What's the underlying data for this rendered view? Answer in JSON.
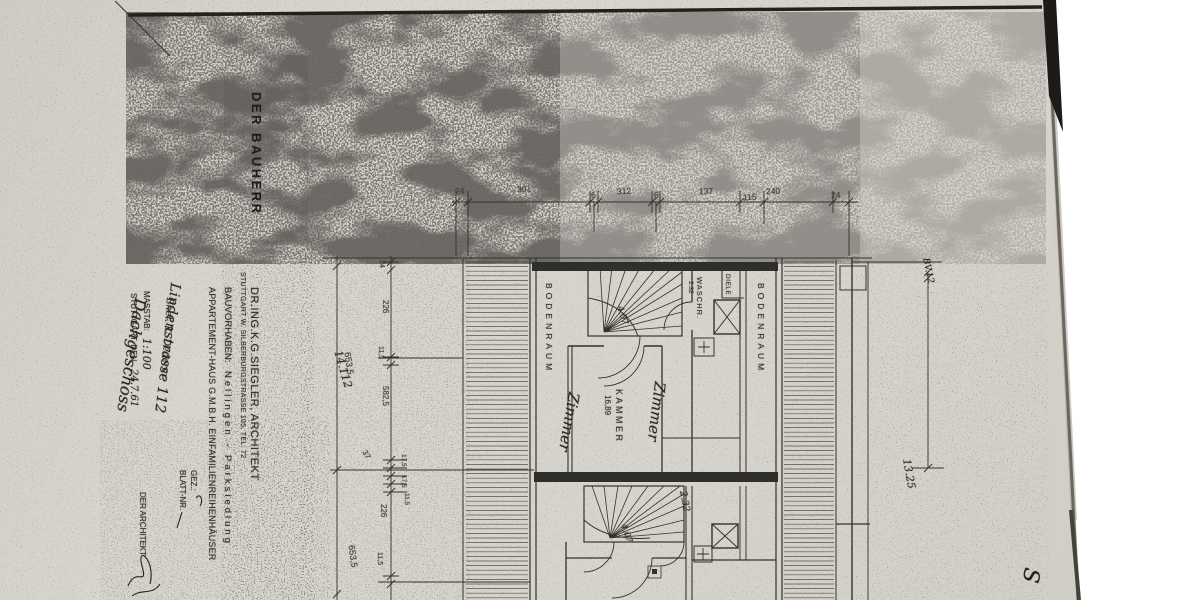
{
  "stamp": {
    "bauherr": "DER BAUHERR"
  },
  "title_block": {
    "architect": "DR.ING.K.G.SIEGLER, ARCHITEKT",
    "address": "STUTTGART W. SILBERBURGSTRASSE 105, TEL. 72",
    "project_label": "BAUVORHABEN:",
    "project": "Nellingen - Parksiedlung",
    "client": "APPARTEMENT-HAUS G.M.B.H. EINFAMILIENREIHENHÄUSER",
    "street": "Lindenstrasse 112",
    "owners": "Ehel. K. Dederer",
    "floor": "Dachgeschoss"
  },
  "meta": {
    "scale_label": "MASSTAB:",
    "scale_value": "1:100",
    "date_label": "STUTTGART, DEN",
    "date_value": "24.7.61",
    "gez_label": "GEZ.:",
    "blatt_label": "BLATT-NR.",
    "architect_label": "DER ARCHITEKT"
  },
  "rooms": {
    "bodenraum_left": "BODENRAUM",
    "bodenraum_right": "BODENRAUM",
    "waschraum": "WASCHR.",
    "waschraum_area": "2.32",
    "diele": "DIELE",
    "kammer": "KAMMER",
    "kammer_area": "16,89"
  },
  "notes": {
    "zimmer_left": "Zimmer",
    "zimmer_right": "Zimmer",
    "stair_1": "4.07",
    "stair_2": "4.07",
    "wasch_2": "2.32",
    "diag_left": "14.112",
    "right_top": "BV.12",
    "right_length": "13.25",
    "corner": "S"
  },
  "dims": {
    "top": [
      "24",
      "301",
      "6",
      "312",
      "6",
      "137",
      "115",
      "240",
      "24"
    ],
    "left_outer": [
      "653,5",
      "653,5"
    ],
    "left_inner": [
      "24",
      "226",
      "11,5",
      "582,5",
      "37",
      "17,5",
      "17,5",
      "11,5",
      "226",
      "11,5"
    ]
  },
  "colors": {
    "paper": "#d7d4cd",
    "ink": "#34322d",
    "noise": "#26241f"
  }
}
